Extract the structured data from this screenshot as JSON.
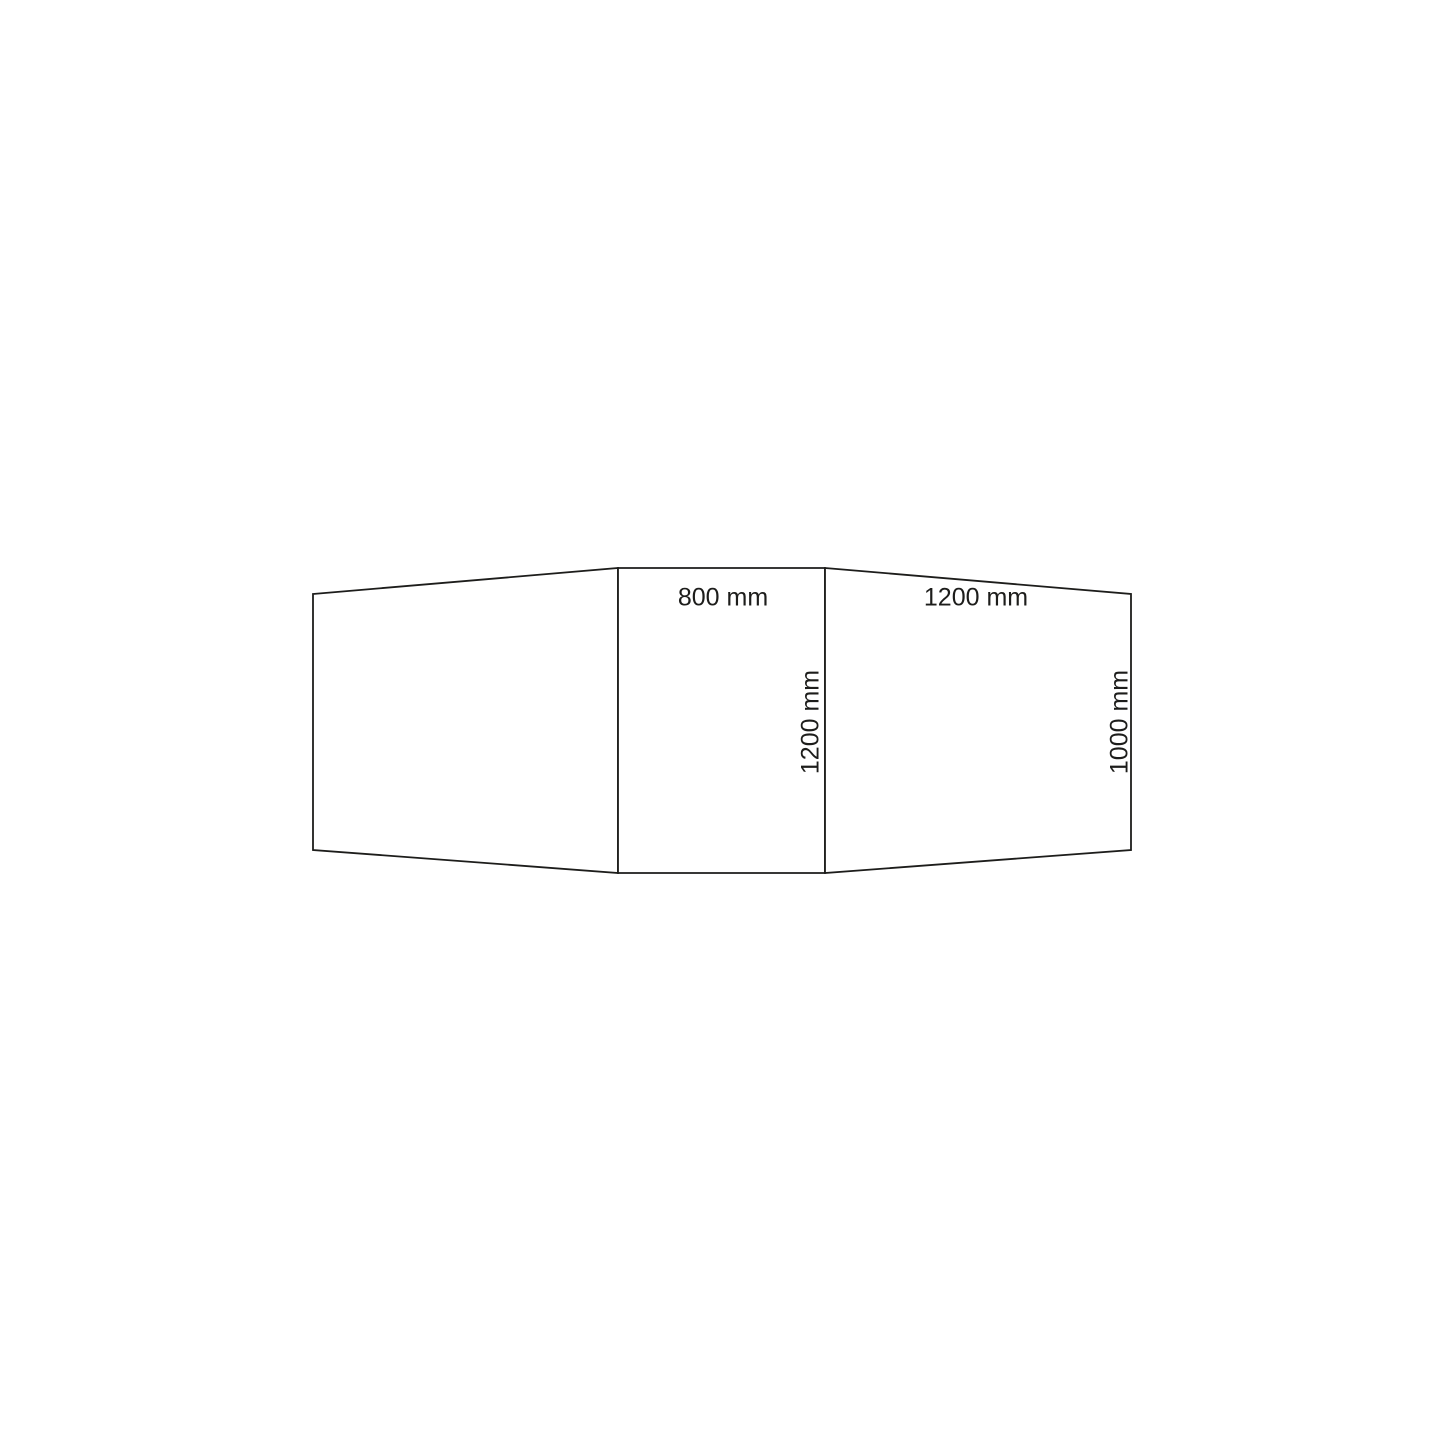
{
  "canvas": {
    "width": 1445,
    "height": 1445,
    "background_color": "#ffffff",
    "line_color": "#1d1d1b",
    "line_width": 1.8,
    "text_color": "#1d1d1b"
  },
  "diagram": {
    "type": "technical-dimension-drawing",
    "panels": [
      {
        "name": "left-panel",
        "points": "313,594 618,568 618,873 313,850"
      },
      {
        "name": "center-panel",
        "points": "618,568 825,568 825,873 618,873"
      },
      {
        "name": "right-panel",
        "points": "825,568 1131,594 1131,850 825,873"
      }
    ],
    "labels": [
      {
        "text": "800 mm",
        "value": 800,
        "unit": "mm",
        "x": 723,
        "y": 598,
        "rotation": 0
      },
      {
        "text": "1200 mm",
        "value": 1200,
        "unit": "mm",
        "x": 976,
        "y": 598,
        "rotation": 0
      },
      {
        "text": "1200 mm",
        "value": 1200,
        "unit": "mm",
        "x": 811,
        "y": 722,
        "rotation": -90
      },
      {
        "text": "1000 mm",
        "value": 1000,
        "unit": "mm",
        "x": 1120,
        "y": 722,
        "rotation": -90
      }
    ]
  }
}
